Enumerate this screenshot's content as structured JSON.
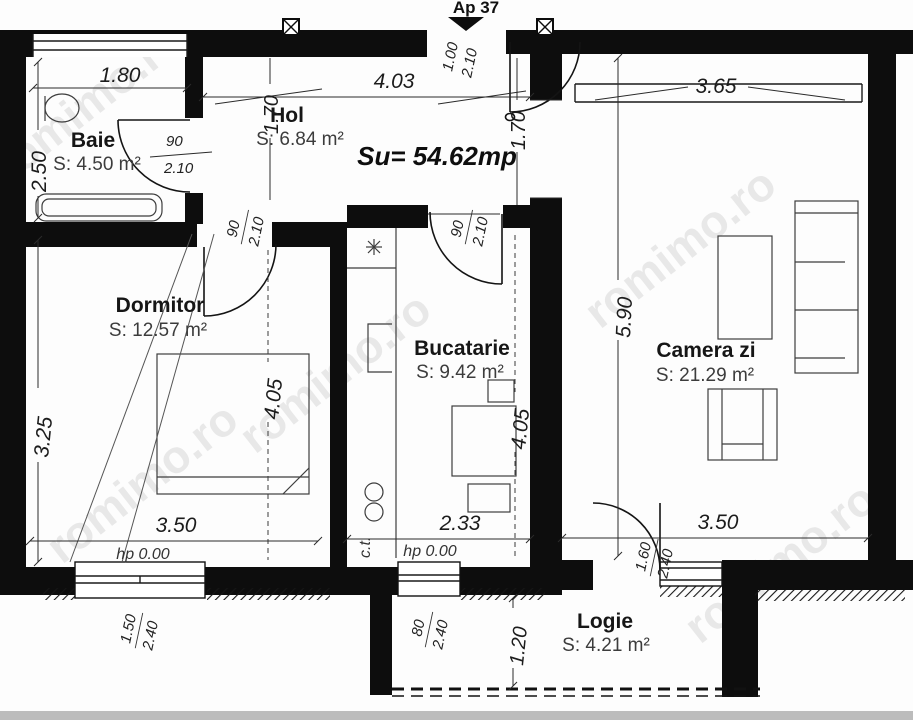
{
  "header": {
    "apartment": "Ap 37",
    "total_area": "Su= 54.62mp"
  },
  "watermark": "romimo.ro",
  "rooms": {
    "baie": {
      "name": "Baie",
      "area": "S: 4.50 m²"
    },
    "hol": {
      "name": "Hol",
      "area": "S: 6.84 m²"
    },
    "dormitor": {
      "name": "Dormitor",
      "area": "S: 12.57 m²"
    },
    "bucatarie": {
      "name": "Bucatarie",
      "area": "S: 9.42 m²"
    },
    "camera_zi": {
      "name": "Camera zi",
      "area": "S: 21.29 m²"
    },
    "logie": {
      "name": "Logie",
      "area": "S: 4.21 m²"
    }
  },
  "dims": {
    "baie_width": "1.80",
    "hol_width": "4.03",
    "camera_zi_width": "3.65",
    "baie_height": "2.50",
    "hol_depth_left": "1.70",
    "hol_depth_right": "1.70",
    "dormitor_height": "3.25",
    "dormitor_depth": "4.05",
    "bucatarie_depth": "4.05",
    "camera_zi_height": "5.90",
    "dormitor_width": "3.50",
    "bucatarie_width": "2.33",
    "camera_zi_bottom_width": "3.50",
    "logie_depth": "1.20",
    "hp_dormitor": "hp 0.00",
    "hp_bucatarie": "hp 0.00",
    "boiler": "c.t."
  },
  "openings": {
    "entrance": {
      "width": "1.00",
      "height": "2.10"
    },
    "baie_door": {
      "width": "90",
      "height": "2.10"
    },
    "dormitor_door": {
      "width": "90",
      "height": "2.10"
    },
    "bucatarie_door": {
      "width": "90",
      "height": "2.10"
    },
    "dormitor_window": {
      "width": "1.50",
      "height": "2.40"
    },
    "bucatarie_window": {
      "width": "80",
      "height": "2.40"
    },
    "logie_door": {
      "width": "1.60",
      "height": "2.40"
    }
  },
  "colors": {
    "wall": "#0d0d0d",
    "dimension_text": "#1c1c1c",
    "furniture": "#3d3d3d",
    "watermark": "#7d7d7d"
  }
}
